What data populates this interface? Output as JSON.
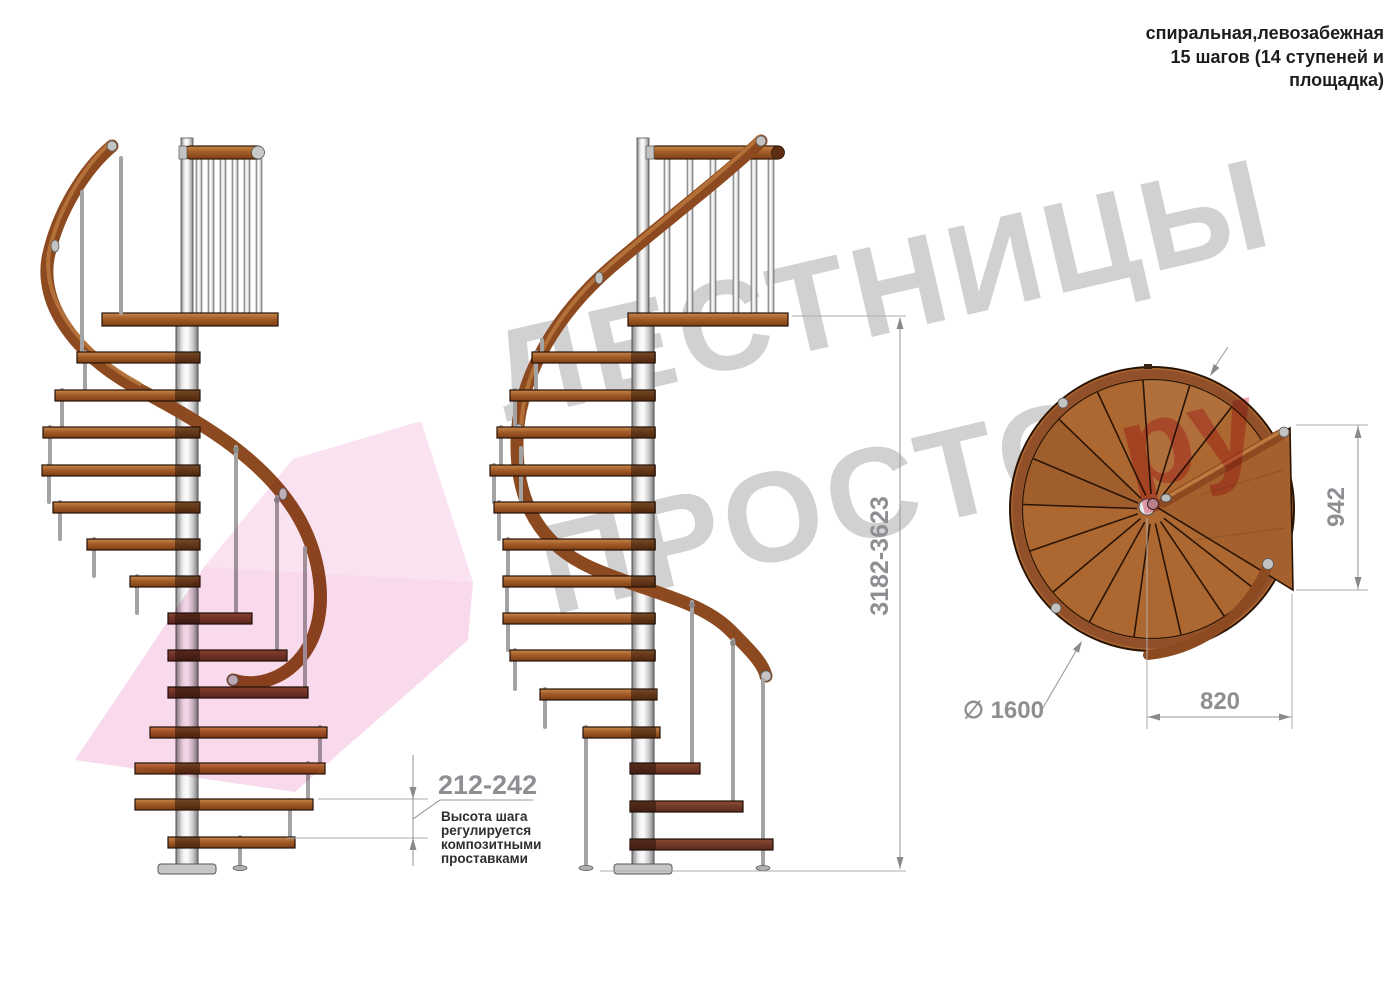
{
  "title": {
    "lines": [
      "спиральная,левозабежная",
      "15 шагов (14 ступеней и",
      "площадка)"
    ]
  },
  "watermark": {
    "line1": "ЛЕСТНИЦЫ",
    "line2": "ПРОСТО",
    "accent": "ру"
  },
  "dimensions": {
    "total_height": "3182-3623",
    "step_height": "212-242",
    "landing_depth": "942",
    "landing_offset": "820",
    "diameter": "∅ 1600"
  },
  "annotations": {
    "step_note": {
      "lines": [
        "Высота шага",
        "регулируется",
        "композитными",
        "проставками"
      ]
    }
  },
  "colors": {
    "wood": "#a9622e",
    "wood_dark": "#6e332a",
    "handrail": "#8d4a20",
    "metal_pole": "#c9c9c9",
    "dimension_text": "#8d8f92",
    "note_text": "#2e2e2e",
    "watermark_gray": "#c9c9c9",
    "watermark_pink": "#f3bcdc",
    "watermark_red": "#e23a56",
    "background": "#ffffff"
  }
}
